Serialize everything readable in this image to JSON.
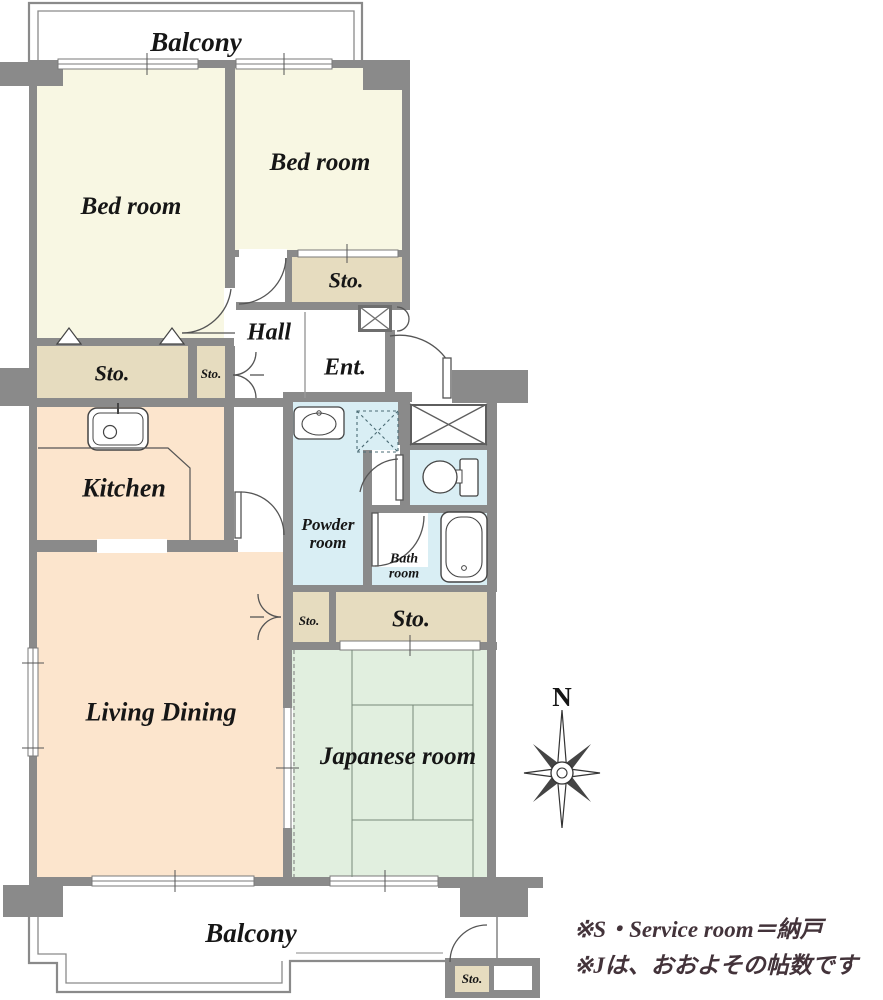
{
  "title": "apartment floor plan",
  "colors": {
    "wall": "#8a8a8a",
    "room_cream": "#f8f7e3",
    "storage_tan": "#e6dcbf",
    "warm_peach": "#fce5cd",
    "water_blue": "#d9eef4",
    "tatami_green": "#e1efdf",
    "line": "#555555",
    "note_text": "#43333a"
  },
  "rooms": {
    "balcony_top": "Balcony",
    "bedroom_left": "Bed room",
    "bedroom_right": "Bed room",
    "storage_bedroom_right": "Sto.",
    "hall": "Hall",
    "entrance": "Ent.",
    "storage_left_large": "Sto.",
    "storage_left_small": "Sto.",
    "kitchen": "Kitchen",
    "powder_room_line1": "Powder",
    "powder_room_line2": "room",
    "bath_room_line1": "Bath",
    "bath_room_line2": "room",
    "storage_mid_small": "Sto.",
    "storage_mid_large": "Sto.",
    "living_dining": "Living Dining",
    "japanese_room": "Japanese room",
    "balcony_bottom": "Balcony",
    "storage_bottom": "Sto."
  },
  "compass": {
    "north_label": "N"
  },
  "notes": {
    "line1": "※S・Service room＝納戸",
    "line2": "※Jは、おおよその帖数です"
  }
}
